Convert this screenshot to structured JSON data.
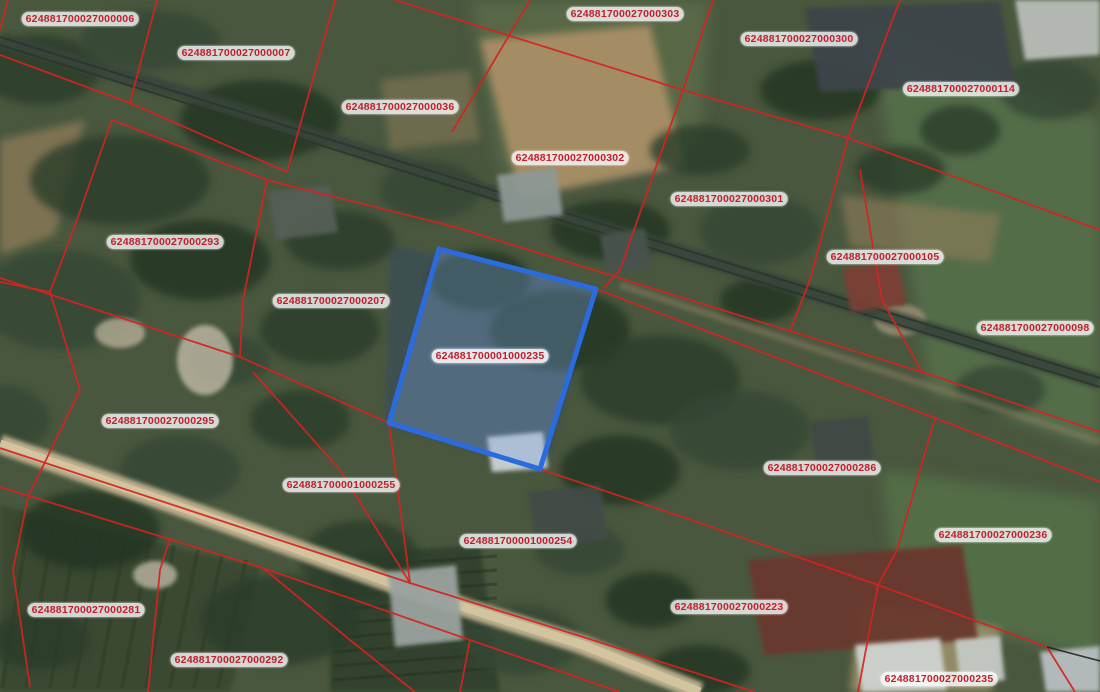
{
  "map": {
    "type": "cadastral-satellite-map",
    "highlighted_parcel_id": "624881700001000235",
    "colors": {
      "parcel_line": "#d32420",
      "label_text": "#c11f2e",
      "label_bg": "rgba(255,255,255,0.78)",
      "highlight_stroke": "#2b6be0",
      "highlight_fill": "rgba(125,165,225,0.32)",
      "survey_line_black": "#1c1c1c"
    },
    "labels": [
      {
        "id": "624881700027000006",
        "x": 80,
        "y": 19
      },
      {
        "id": "624881700027000007",
        "x": 236,
        "y": 53
      },
      {
        "id": "624881700027000036",
        "x": 400,
        "y": 107
      },
      {
        "id": "624881700027000303",
        "x": 625,
        "y": 14
      },
      {
        "id": "624881700027000300",
        "x": 799,
        "y": 39
      },
      {
        "id": "624881700027000114",
        "x": 961,
        "y": 89
      },
      {
        "id": "624881700027000302",
        "x": 570,
        "y": 158
      },
      {
        "id": "624881700027000301",
        "x": 729,
        "y": 199
      },
      {
        "id": "624881700027000105",
        "x": 885,
        "y": 257
      },
      {
        "id": "624881700027000293",
        "x": 165,
        "y": 242
      },
      {
        "id": "624881700027000207",
        "x": 331,
        "y": 301
      },
      {
        "id": "624881700027000098",
        "x": 1035,
        "y": 328
      },
      {
        "id": "624881700001000235",
        "x": 490,
        "y": 356,
        "highlighted": true
      },
      {
        "id": "624881700027000295",
        "x": 160,
        "y": 421
      },
      {
        "id": "624881700027000286",
        "x": 822,
        "y": 468
      },
      {
        "id": "624881700001000255",
        "x": 341,
        "y": 485
      },
      {
        "id": "624881700001000254",
        "x": 518,
        "y": 541
      },
      {
        "id": "624881700027000236",
        "x": 993,
        "y": 535
      },
      {
        "id": "624881700027000281",
        "x": 86,
        "y": 610
      },
      {
        "id": "624881700027000223",
        "x": 729,
        "y": 607
      },
      {
        "id": "624881700027000292",
        "x": 229,
        "y": 660
      },
      {
        "id": "624881700027000235",
        "x": 939,
        "y": 679
      }
    ],
    "highlight_polygon": [
      [
        439,
        249
      ],
      [
        596,
        289
      ],
      [
        540,
        469
      ],
      [
        389,
        423
      ]
    ],
    "boundary_lines": [
      [
        [
          0,
          55
        ],
        [
          130,
          103
        ],
        [
          287,
          172
        ]
      ],
      [
        [
          157,
          0
        ],
        [
          130,
          103
        ]
      ],
      [
        [
          335,
          0
        ],
        [
          287,
          172
        ]
      ],
      [
        [
          112,
          120
        ],
        [
          267,
          180
        ],
        [
          455,
          227
        ],
        [
          922,
          372
        ],
        [
          1100,
          432
        ]
      ],
      [
        [
          267,
          180
        ],
        [
          243,
          300
        ],
        [
          240,
          357
        ]
      ],
      [
        [
          0,
          278
        ],
        [
          240,
          357
        ],
        [
          389,
          423
        ]
      ],
      [
        [
          112,
          120
        ],
        [
          77,
          220
        ],
        [
          50,
          292
        ]
      ],
      [
        [
          50,
          292
        ],
        [
          0,
          282
        ]
      ],
      [
        [
          50,
          292
        ],
        [
          80,
          390
        ],
        [
          28,
          497
        ]
      ],
      [
        [
          395,
          0
        ],
        [
          683,
          90
        ],
        [
          848,
          138
        ],
        [
          1100,
          230
        ]
      ],
      [
        [
          530,
          0
        ],
        [
          452,
          132
        ]
      ],
      [
        [
          713,
          0
        ],
        [
          683,
          90
        ],
        [
          620,
          270
        ],
        [
          604,
          288
        ]
      ],
      [
        [
          900,
          0
        ],
        [
          848,
          138
        ]
      ],
      [
        [
          848,
          138
        ],
        [
          810,
          280
        ],
        [
          790,
          331
        ]
      ],
      [
        [
          860,
          170
        ],
        [
          882,
          300
        ],
        [
          922,
          372
        ]
      ],
      [
        [
          596,
          289
        ],
        [
          935,
          418
        ],
        [
          1095,
          480
        ],
        [
          1100,
          482
        ]
      ],
      [
        [
          935,
          418
        ],
        [
          897,
          550
        ],
        [
          878,
          585
        ],
        [
          858,
          692
        ]
      ],
      [
        [
          253,
          372
        ],
        [
          340,
          470
        ],
        [
          410,
          583
        ]
      ],
      [
        [
          389,
          423
        ],
        [
          410,
          583
        ]
      ],
      [
        [
          0,
          448
        ],
        [
          410,
          583
        ],
        [
          583,
          637
        ],
        [
          755,
          692
        ]
      ],
      [
        [
          540,
          469
        ],
        [
          700,
          523
        ],
        [
          878,
          585
        ],
        [
          1047,
          647
        ]
      ],
      [
        [
          0,
          487
        ],
        [
          263,
          568
        ],
        [
          470,
          640
        ],
        [
          620,
          692
        ]
      ],
      [
        [
          28,
          497
        ],
        [
          13,
          570
        ],
        [
          30,
          687
        ]
      ],
      [
        [
          170,
          538
        ],
        [
          160,
          570
        ],
        [
          148,
          692
        ]
      ],
      [
        [
          263,
          568
        ],
        [
          350,
          640
        ],
        [
          415,
          692
        ]
      ],
      [
        [
          470,
          640
        ],
        [
          460,
          692
        ]
      ],
      [
        [
          1047,
          647
        ],
        [
          1075,
          692
        ]
      ],
      [
        [
          0,
          30
        ],
        [
          8,
          0
        ]
      ]
    ],
    "survey_lines_black": [
      [
        [
          1047,
          647
        ],
        [
          1100,
          661
        ]
      ]
    ]
  }
}
